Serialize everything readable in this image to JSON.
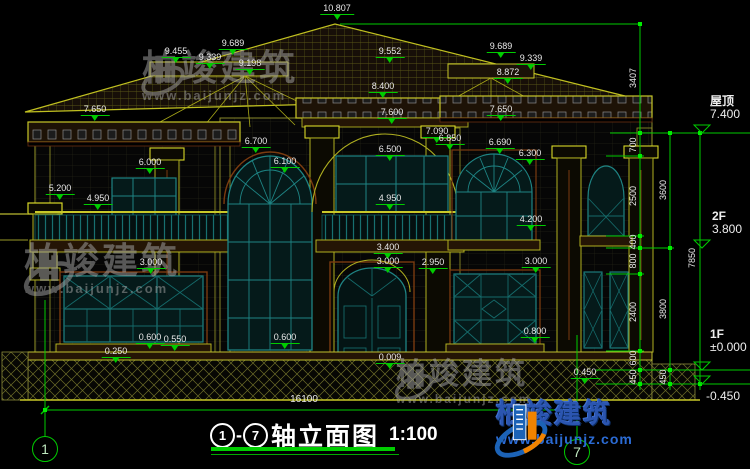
{
  "title": {
    "axis_start": "1",
    "axis_end": "7",
    "separator": "-",
    "name": "轴立面图",
    "scale": "1:100"
  },
  "bottom": {
    "overall_dim": "16100"
  },
  "axis_bubbles": [
    {
      "label": "1",
      "x": 45,
      "y": 449
    },
    {
      "label": "7",
      "x": 577,
      "y": 452
    }
  ],
  "elevation_labels": [
    {
      "text": "10.807",
      "x": 337,
      "y": 3
    },
    {
      "text": "9.455",
      "x": 176,
      "y": 46
    },
    {
      "text": "9.689",
      "x": 233,
      "y": 38
    },
    {
      "text": "9.339",
      "x": 210,
      "y": 52
    },
    {
      "text": "9.198",
      "x": 250,
      "y": 58
    },
    {
      "text": "9.552",
      "x": 390,
      "y": 46
    },
    {
      "text": "8.400",
      "x": 383,
      "y": 81
    },
    {
      "text": "9.689",
      "x": 501,
      "y": 41
    },
    {
      "text": "9.339",
      "x": 531,
      "y": 53
    },
    {
      "text": "8.872",
      "x": 508,
      "y": 67
    },
    {
      "text": "7.650",
      "x": 95,
      "y": 104
    },
    {
      "text": "7.650",
      "x": 501,
      "y": 104
    },
    {
      "text": "7.600",
      "x": 392,
      "y": 107
    },
    {
      "text": "7.090",
      "x": 437,
      "y": 126
    },
    {
      "text": "6.850",
      "x": 450,
      "y": 133
    },
    {
      "text": "6.690",
      "x": 500,
      "y": 137
    },
    {
      "text": "6.500",
      "x": 390,
      "y": 144
    },
    {
      "text": "6.300",
      "x": 530,
      "y": 148
    },
    {
      "text": "6.700",
      "x": 256,
      "y": 136
    },
    {
      "text": "6.100",
      "x": 285,
      "y": 156
    },
    {
      "text": "6.000",
      "x": 150,
      "y": 157
    },
    {
      "text": "5.200",
      "x": 60,
      "y": 183
    },
    {
      "text": "4.950",
      "x": 98,
      "y": 193
    },
    {
      "text": "4.950",
      "x": 390,
      "y": 193
    },
    {
      "text": "4.200",
      "x": 531,
      "y": 214
    },
    {
      "text": "3.400",
      "x": 388,
      "y": 242
    },
    {
      "text": "3.000",
      "x": 388,
      "y": 256
    },
    {
      "text": "2.950",
      "x": 433,
      "y": 257
    },
    {
      "text": "3.000",
      "x": 151,
      "y": 257
    },
    {
      "text": "3.000",
      "x": 536,
      "y": 256
    },
    {
      "text": "0.800",
      "x": 535,
      "y": 326
    },
    {
      "text": "0.600",
      "x": 150,
      "y": 332
    },
    {
      "text": "0.550",
      "x": 175,
      "y": 334
    },
    {
      "text": "0.600",
      "x": 285,
      "y": 332
    },
    {
      "text": "0.250",
      "x": 116,
      "y": 346
    },
    {
      "text": "0.009",
      "x": 390,
      "y": 352
    },
    {
      "text": "0.450",
      "x": 585,
      "y": 367
    }
  ],
  "chain_dims": [
    {
      "text": "3407",
      "x": 633,
      "y": 78
    },
    {
      "text": "700",
      "x": 633,
      "y": 145
    },
    {
      "text": "2500",
      "x": 633,
      "y": 196
    },
    {
      "text": "400",
      "x": 633,
      "y": 242
    },
    {
      "text": "800",
      "x": 633,
      "y": 261
    },
    {
      "text": "2400",
      "x": 633,
      "y": 312
    },
    {
      "text": "600",
      "x": 633,
      "y": 358
    },
    {
      "text": "450",
      "x": 633,
      "y": 377
    },
    {
      "text": "3600",
      "x": 663,
      "y": 190
    },
    {
      "text": "3800",
      "x": 663,
      "y": 309
    },
    {
      "text": "450",
      "x": 663,
      "y": 377
    },
    {
      "text": "7850",
      "x": 692,
      "y": 258
    }
  ],
  "level_markers": [
    {
      "name": "屋顶",
      "value": "7.400",
      "x": 710,
      "y": 95
    },
    {
      "name": "2F",
      "value": "3.800",
      "x": 712,
      "y": 210
    },
    {
      "name": "1F",
      "value": "±0.000",
      "x": 710,
      "y": 328
    },
    {
      "name": "",
      "value": "-0.450",
      "x": 706,
      "y": 390
    }
  ],
  "watermark": {
    "brand": "柏竣建筑",
    "url": "www.baijunjz.com"
  },
  "logo": {
    "brand": "柏竣建筑",
    "url": "www.baijunjz.com"
  },
  "colors": {
    "background": "#000000",
    "dimension_green": "#00cc00",
    "text_white": "#e9e9e9",
    "outline_olive": "#a8a81e",
    "outline_bright": "#cfcf28",
    "window_teal": "#1e8484",
    "trim_brown": "#7a3b10",
    "logo_blue": "#1c63b7",
    "logo_orange": "#f08300",
    "watermark_gray": "#a8a8a8"
  }
}
